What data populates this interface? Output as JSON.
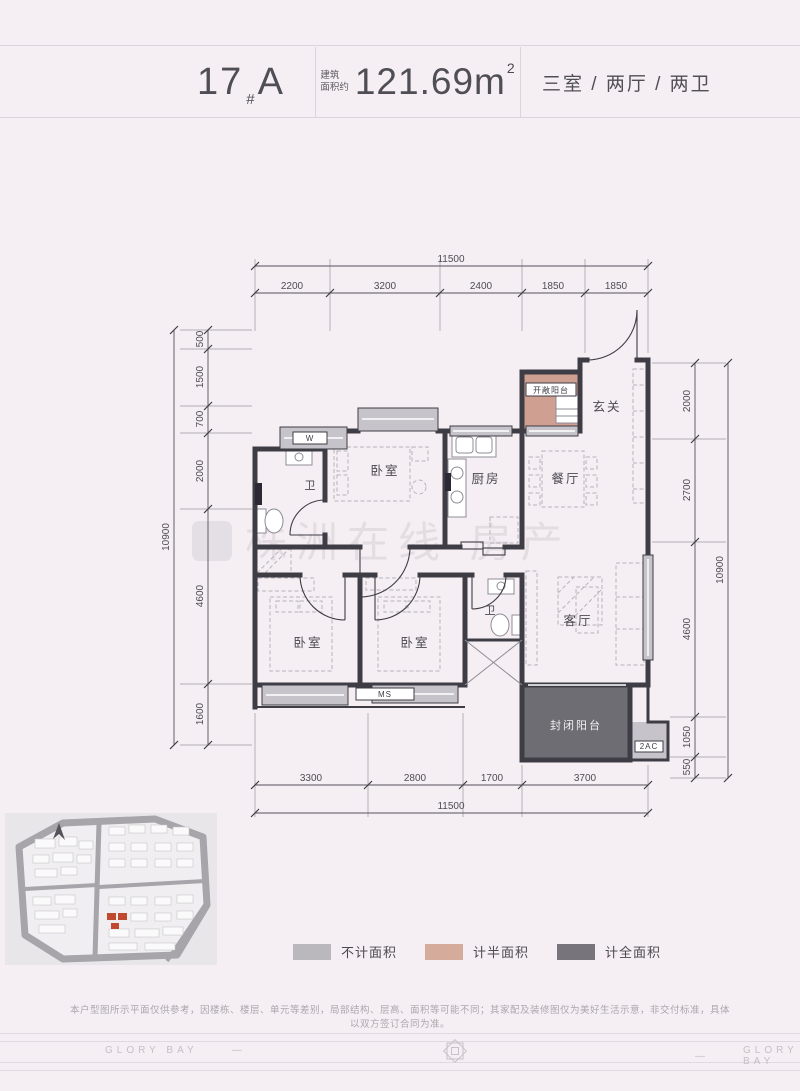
{
  "colors": {
    "page_bg": "#f5eff3",
    "wall": "#3e3c44",
    "no_area": "#c6c4ca",
    "half_area": "#cf9f92",
    "full_area": "#6e6d73",
    "highlight": "#bf4a2d"
  },
  "header": {
    "block_number": "17",
    "block_sep": "#",
    "unit": "A",
    "area_label_1": "建筑",
    "area_label_2": "面积约",
    "area_value": "121.69",
    "area_unit": "m",
    "area_exp": "2",
    "layout_summary": "三室 / 两厅 / 两卫"
  },
  "plan": {
    "watermark": "株洲在线 房产",
    "rooms": {
      "foyer": "玄关",
      "open_balcony": "开敞阳台",
      "dining": "餐厅",
      "kitchen": "厨房",
      "bedroom_top": "卧室",
      "bath_top": "卫",
      "bedroom_left": "卧室",
      "bedroom_mid": "卧室",
      "bath_bottom": "卫",
      "living": "客厅",
      "closed_balcony": "封闭阳台",
      "washer_tag": "W",
      "bay_tag": "MS",
      "ac_tag": "2AC"
    },
    "dims": {
      "top_total": "11500",
      "top_segments": [
        "2200",
        "3200",
        "2400",
        "1850",
        "1850"
      ],
      "left_total": "10900",
      "left_segments": [
        "500",
        "1500",
        "700",
        "2000",
        "4600",
        "1600"
      ],
      "right_total": "10900",
      "right_segments": [
        "2000",
        "2700",
        "4600",
        "1050",
        "550"
      ],
      "bottom_total": "11500",
      "bottom_segments": [
        "3300",
        "2800",
        "1700",
        "3700"
      ]
    }
  },
  "legend": {
    "items": [
      {
        "label": "不计面积",
        "color": "#bab8bd"
      },
      {
        "label": "计半面积",
        "color": "#d5ac9b"
      },
      {
        "label": "计全面积",
        "color": "#77757b"
      }
    ]
  },
  "disclaimer": "本户型图所示平面仅供参考，因楼栋、楼层、单元等差别，局部结构、层高、面积等可能不同；其家配及装修图仅为美好生活示意，非交付标准，具体以双方签订合同为准。",
  "footer": {
    "brand": "GLORY BAY",
    "dash": "—"
  }
}
